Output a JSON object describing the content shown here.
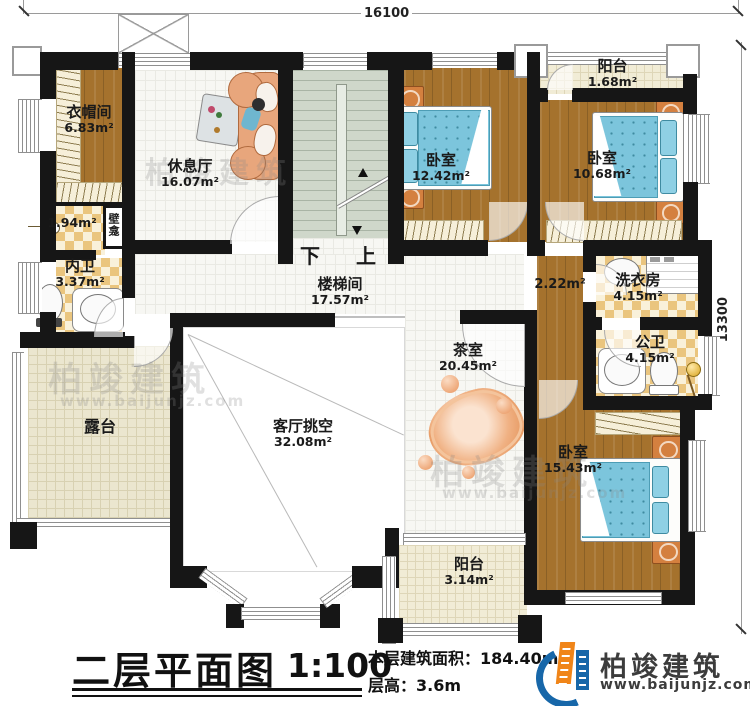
{
  "rooms": {
    "cloakroom": {
      "name": "衣帽间",
      "area": "6.83m²"
    },
    "lounge": {
      "name": "休息厅",
      "area": "16.07m²"
    },
    "bedroom1": {
      "name": "卧室",
      "area": "12.42m²"
    },
    "bedroom2": {
      "name": "卧室",
      "area": "10.68m²"
    },
    "balcony_top": {
      "name": "阳台",
      "area": "1.68m²"
    },
    "niche": {
      "name": "壁龛"
    },
    "shower": {
      "area": "1.94m²"
    },
    "inner_bath": {
      "name": "内卫",
      "area": "3.37m²"
    },
    "stairwell": {
      "name": "楼梯间",
      "area": "17.57m²"
    },
    "corridor": {
      "area": "2.22m²"
    },
    "laundry": {
      "name": "洗衣房",
      "area": "4.15m²"
    },
    "public_bath": {
      "name": "公卫",
      "area": "4.15m²"
    },
    "tea_room": {
      "name": "茶室",
      "area": "20.45m²"
    },
    "living_void": {
      "name": "客厅挑空",
      "area": "32.08m²"
    },
    "terrace": {
      "name": "露台"
    },
    "bedroom3": {
      "name": "卧室",
      "area": "15.43m²"
    },
    "balcony_bottom": {
      "name": "阳台",
      "area": "3.14m²"
    }
  },
  "stairs": {
    "down": "下",
    "up": "上"
  },
  "dimensions": {
    "width": "16100",
    "height": "13300"
  },
  "legend": {
    "title": "二层平面图",
    "scale": "1:100",
    "area_label": "本层建筑面积：",
    "area_value": "184.40m²",
    "height_label": "层高：",
    "height_value": "3.6m"
  },
  "brand": {
    "name": "柏竣建筑",
    "url": "www.baijunjz.com"
  },
  "watermark": {
    "text": "柏竣建筑",
    "url": "www.baijunjz.com"
  },
  "colors": {
    "wall": "#161616",
    "wood": "#a5722d",
    "tile": "#f7f7f3",
    "checker": "#eac57e",
    "stair": "#cfd7ca",
    "balcony": "#f1ecd6",
    "bed": "#7cc5dc",
    "brand_orange": "#f08519",
    "brand_blue": "#1767a9"
  }
}
